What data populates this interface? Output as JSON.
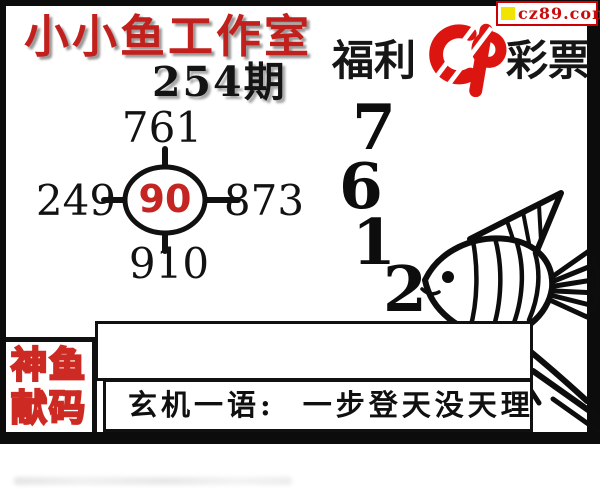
{
  "badge": {
    "site": "cz89.com"
  },
  "header": {
    "studio_title": "小小鱼工作室",
    "issue_label": "254期"
  },
  "brand": {
    "prefix": "福利",
    "suffix": "彩票",
    "logo": "china-welfare-lottery-logo"
  },
  "number_diagram": {
    "top": "761",
    "left": "249",
    "right": "873",
    "bottom": "910",
    "center": "90"
  },
  "digits": [
    "7",
    "6",
    "1",
    "2"
  ],
  "mascot": "angelfish-line-drawing",
  "stamp": {
    "line1": "神鱼",
    "line2": "献码"
  },
  "hint": {
    "label": "玄机一语:",
    "phrase": "一步登天没天理"
  },
  "note": {
    "value": ""
  },
  "colors": {
    "title_red": "#c2201c",
    "logo_red": "#dd1510",
    "center_red": "#c52522",
    "badge_red": "#c90c0c",
    "badge_yellow": "#f0e400",
    "frame_black": "#0c0c0c"
  }
}
